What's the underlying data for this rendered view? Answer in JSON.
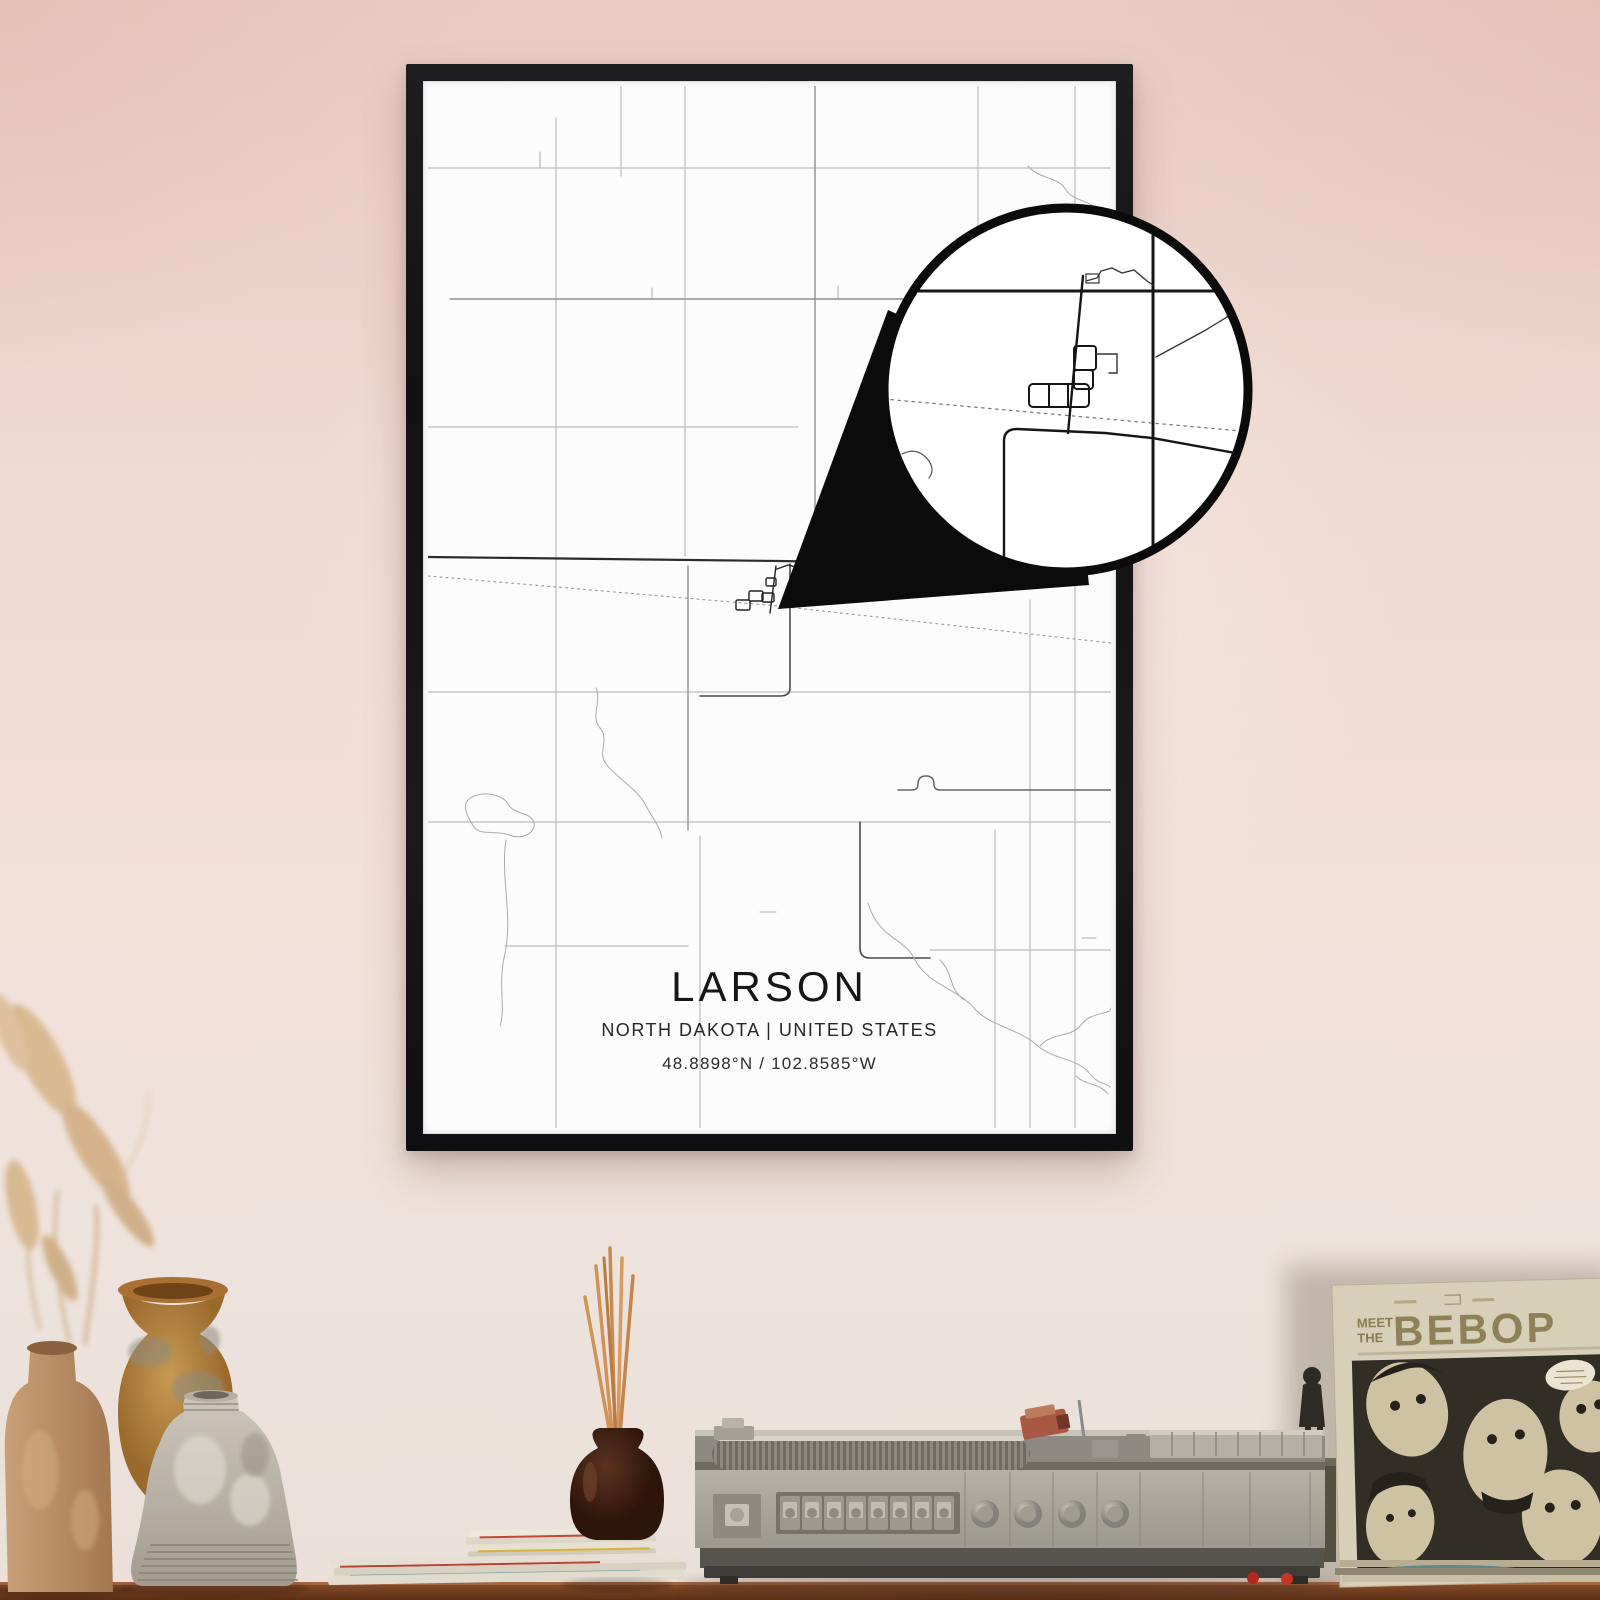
{
  "poster": {
    "title": "LARSON",
    "subtitle": "NORTH DAKOTA | UNITED STATES",
    "coordinates": "48.8898°N / 102.8585°W"
  },
  "record_sleeve": {
    "line1": "MEET",
    "line2": "THE",
    "title": "BEBOP"
  },
  "colors": {
    "wall": "#efd8d0",
    "frame": "#141416",
    "poster": "#fcfcfd",
    "road_dark": "#2b2b2b",
    "road_light": "#bdbdbd",
    "lens_border": "#0b0b0b",
    "desk": "#7c4527",
    "player_body": "#aba69c",
    "sleeve": "#d8cfb8",
    "sleeve_art_bg": "#332e25",
    "accent_red": "#b3281e",
    "incense_stick": "#d29257"
  }
}
